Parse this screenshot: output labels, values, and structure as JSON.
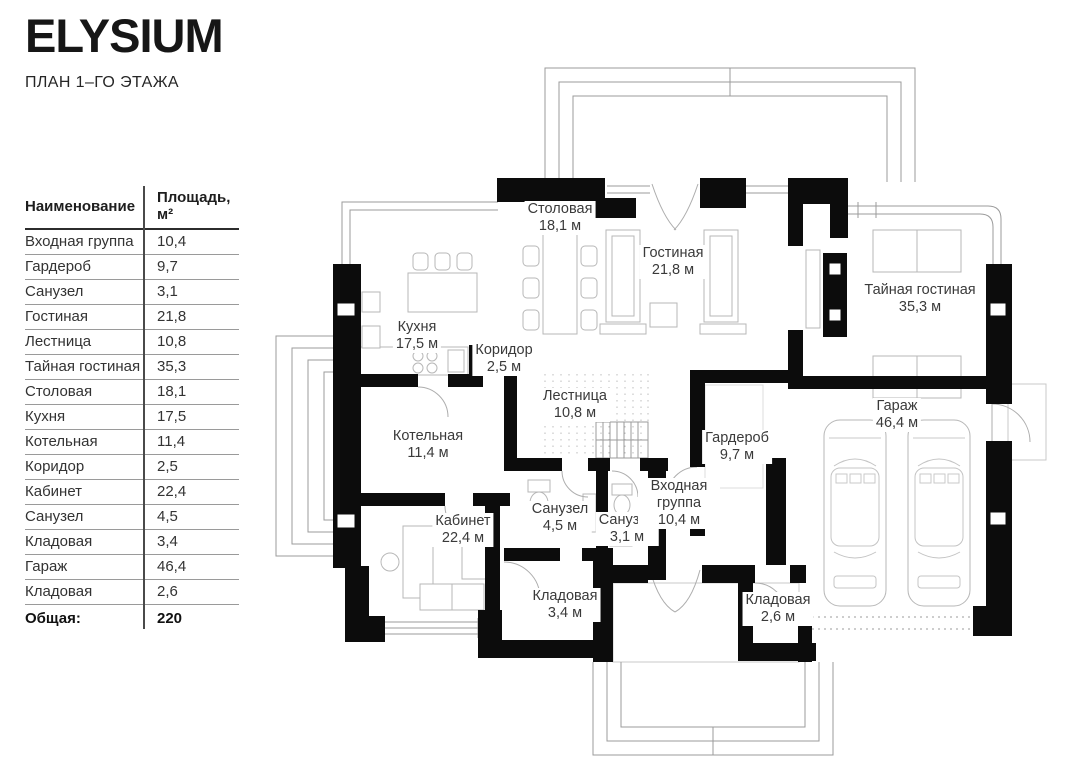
{
  "brand": {
    "logo": "ELYSIUM",
    "subtitle": "ПЛАН 1–ГО ЭТАЖА"
  },
  "table": {
    "headers": {
      "name": "Наименование",
      "area": "Площадь, м²"
    },
    "rows": [
      {
        "name": "Входная группа",
        "area": "10,4"
      },
      {
        "name": "Гардероб",
        "area": "9,7"
      },
      {
        "name": "Санузел",
        "area": "3,1"
      },
      {
        "name": "Гостиная",
        "area": "21,8"
      },
      {
        "name": "Лестница",
        "area": "10,8"
      },
      {
        "name": "Тайная гостиная",
        "area": "35,3"
      },
      {
        "name": "Столовая",
        "area": "18,1"
      },
      {
        "name": "Кухня",
        "area": "17,5"
      },
      {
        "name": "Котельная",
        "area": "11,4"
      },
      {
        "name": "Коридор",
        "area": "2,5"
      },
      {
        "name": "Кабинет",
        "area": "22,4"
      },
      {
        "name": "Санузел",
        "area": "4,5"
      },
      {
        "name": "Кладовая",
        "area": "3,4"
      },
      {
        "name": "Гараж",
        "area": "46,4"
      },
      {
        "name": "Кладовая",
        "area": "2,6"
      }
    ],
    "total": {
      "label": "Общая:",
      "value": "220"
    }
  },
  "plan": {
    "rooms": [
      {
        "name": "Столовая",
        "area": "18,1 м"
      },
      {
        "name": "Гостиная",
        "area": "21,8 м"
      },
      {
        "name": "Тайная гостиная",
        "area": "35,3 м"
      },
      {
        "name": "Кухня",
        "area": "17,5 м"
      },
      {
        "name": "Коридор",
        "area": "2,5 м"
      },
      {
        "name": "Лестница",
        "area": "10,8 м"
      },
      {
        "name": "Котельная",
        "area": "11,4 м"
      },
      {
        "name": "Гардероб",
        "area": "9,7 м"
      },
      {
        "name": "Гараж",
        "area": "46,4 м"
      },
      {
        "name": "Кабинет",
        "area": "22,4 м"
      },
      {
        "name": "Санузел",
        "area": "4,5 м"
      },
      {
        "name": "Санузел",
        "area": "3,1 м"
      },
      {
        "name": "Входная группа",
        "area": "10,4 м"
      },
      {
        "name": "Кладовая",
        "area": "3,4 м"
      },
      {
        "name": "Кладовая",
        "area": "2,6 м"
      }
    ]
  },
  "colors": {
    "wall": "#0c0c0c",
    "text": "#3a3a3a",
    "furniture": "#b7b7b7",
    "thin_outline": "#9b9b9b"
  }
}
